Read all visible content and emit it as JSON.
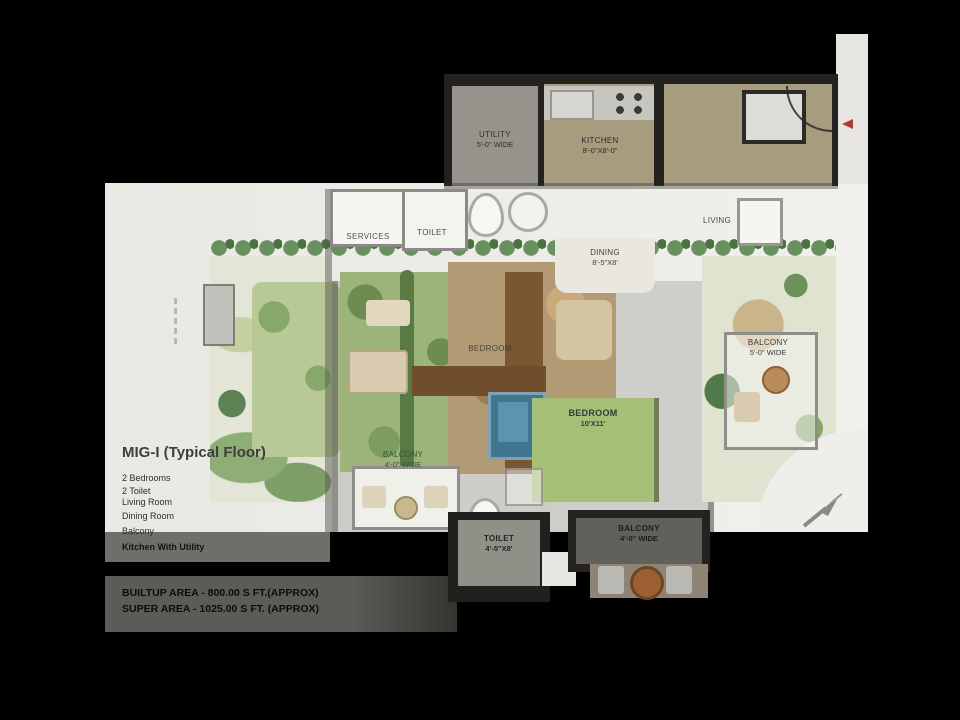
{
  "plan": {
    "title": "MIG-I (Typical Floor)",
    "features": [
      "2 Bedrooms",
      "2 Toilet",
      "Living Room",
      "Dining Room",
      "Balcony",
      "Kitchen With Utility"
    ],
    "area_lines": [
      "BUILTUP AREA - 800.00 S FT.(APPROX)",
      "SUPER AREA - 1025.00 S FT. (APPROX)"
    ]
  },
  "rooms": {
    "utility": {
      "name": "UTILITY",
      "dim": "5'-0\" WIDE"
    },
    "kitchen": {
      "name": "KITCHEN",
      "dim": "8'-0\"X8'-0\""
    },
    "services": {
      "name": "SERVICES",
      "dim": ""
    },
    "toilet_top": {
      "name": "TOILET",
      "dim": ""
    },
    "living": {
      "name": "LIVING",
      "dim": ""
    },
    "dining": {
      "name": "DINING",
      "dim": "8'-5\"X8'"
    },
    "bedroom_upper": {
      "name": "BEDROOM",
      "dim": ""
    },
    "bedroom_lower": {
      "name": "BEDROOM",
      "dim": "10'X11'"
    },
    "balcony_right": {
      "name": "BALCONY",
      "dim": "5'-0\" WIDE"
    },
    "balcony_left": {
      "name": "BALCONY",
      "dim": "4'-0\" WIDE"
    },
    "toilet_bottom": {
      "name": "TOILET",
      "dim": "4'-5\"X8'"
    },
    "balcony_bottom": {
      "name": "BALCONY",
      "dim": "4'-0\" WIDE"
    }
  },
  "icons": {
    "north_arrow_icon": "northeast-arrow",
    "red_marker_icon": "left-triangle-marker"
  },
  "colors": {
    "background": "#000000",
    "paper_white": "#edece8",
    "wall_dark": "#23221f",
    "floor_tan": "#a69d7e",
    "lawn_green": "#9cb47a",
    "path_brown": "#7b5731",
    "pool_blue": "#40758f",
    "marker_red": "#b03a2e"
  }
}
